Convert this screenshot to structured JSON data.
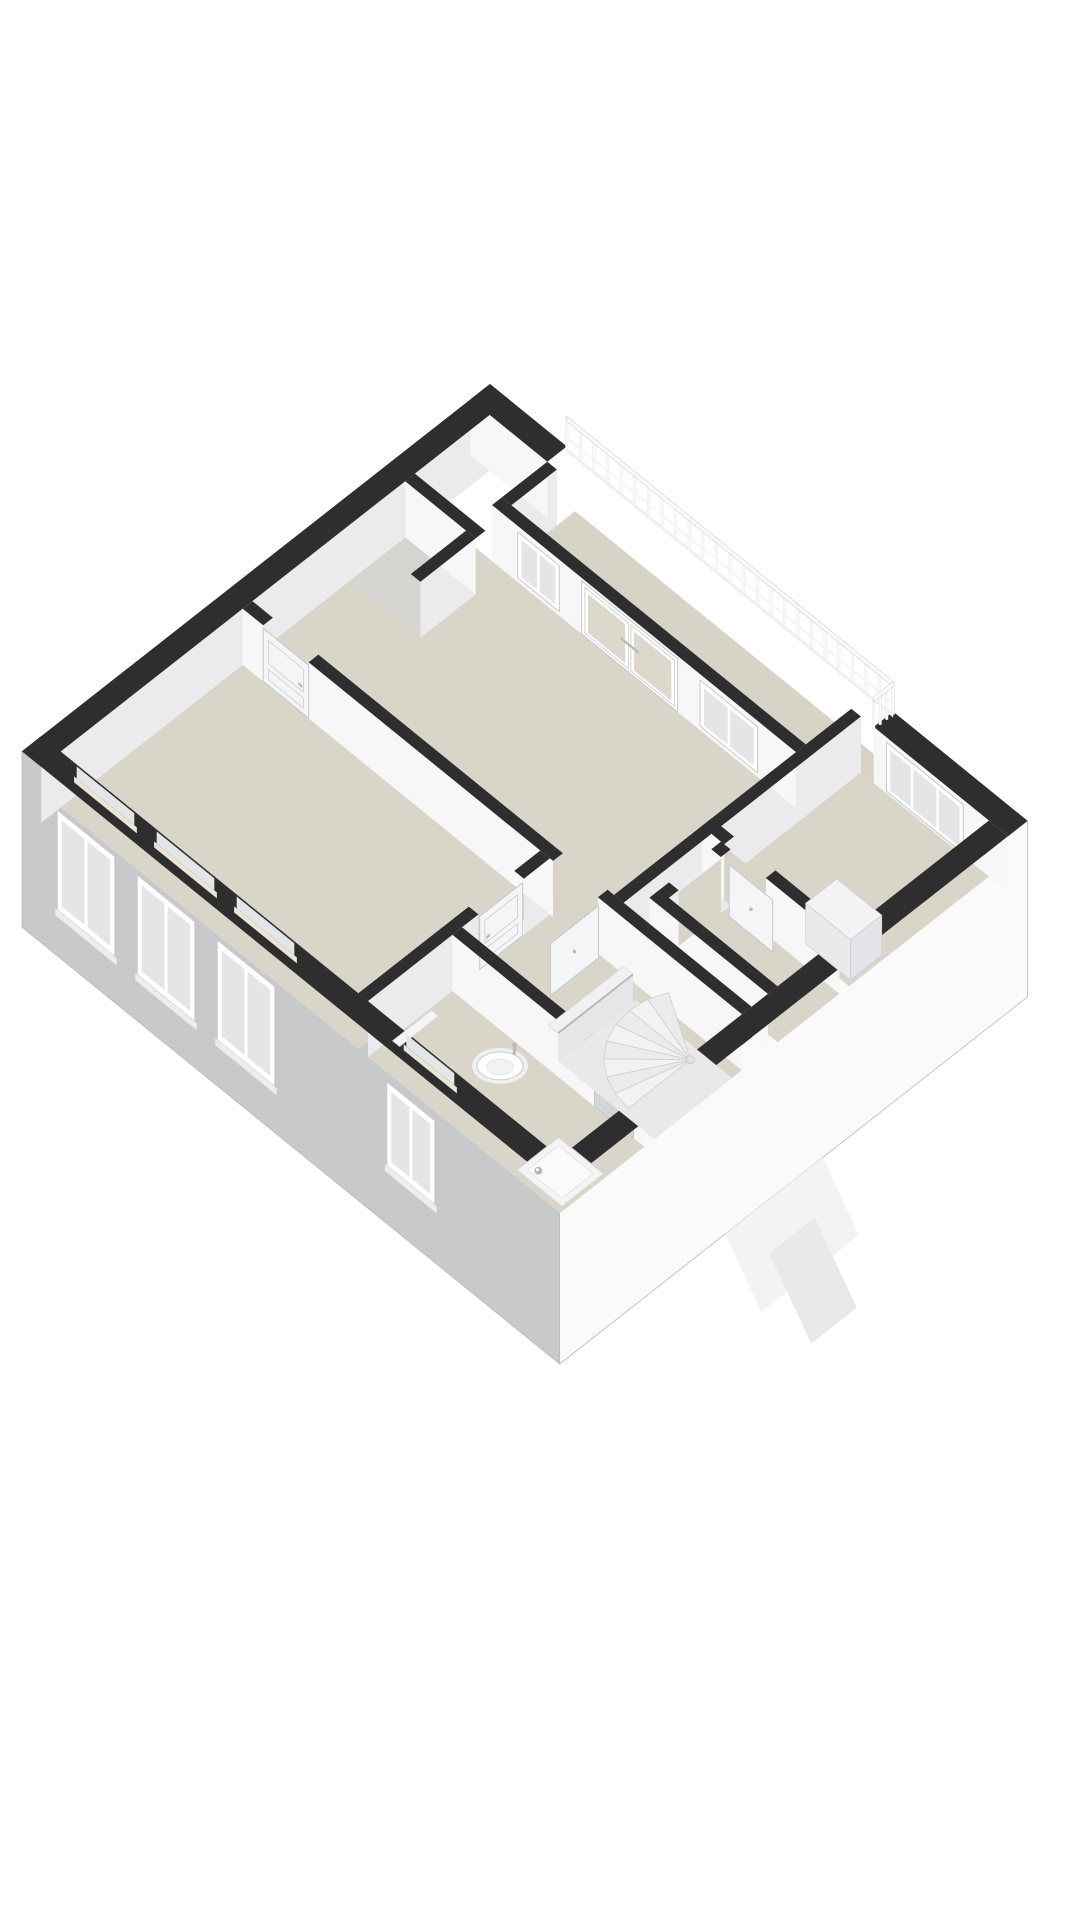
{
  "meta": {
    "kind": "3d-floorplan-render",
    "visible_text": ""
  },
  "scene": {
    "canvas": {
      "w": 1080,
      "h": 1920
    },
    "projection": {
      "origin": [
        490,
        384
      ],
      "ex": [
        64,
        52
      ],
      "ey": [
        -65,
        51
      ],
      "drop": 56,
      "facadeDrop": 176
    },
    "palette": {
      "bg": "#ffffff",
      "wallTop": "#2e2e2e",
      "floor": "#d9d5c9",
      "floorAlt": "#d4d4d0",
      "floorLoggia": "#d7d3c6",
      "faceLit": "#f7f7f8",
      "faceShade": "#ebebee",
      "opening": "#d8d4c8",
      "facadeSW": "#c8c9cb",
      "facadeSE": "#fafafb",
      "facadeEdge": "#b9babc",
      "glass": "#e3e5e7",
      "glassWarm": "#dcd8cc",
      "frame": "#ffffff",
      "frameEdge": "#c7c9cb",
      "sill": "#eae5d6",
      "tread": "#f2f2f3",
      "treadAlt": "#ebebed",
      "treadEdge": "#cfcfd2",
      "well": "#e9e9ea",
      "fixture": "#ffffff",
      "fixtureEdge": "#c9cbcd",
      "fixtureInner": "#f1f2f3",
      "chrome": "#b7babd",
      "leafGray": "#d4d6d9",
      "leafWhite": "#f4f5f6",
      "leafEdge": "#c5c7ca",
      "railPost": "#fbfbfc",
      "railPostShadow": "#e8e8ea",
      "railBar": "#fcfcfd",
      "railEdge": "#d5d5d8",
      "halfWallTop": "#f1f1f2",
      "halfWallFace": "#e6e6e9",
      "halfWallEdge": "#d9d9db",
      "cupboardTop": "#f3f3f4",
      "cupboardFace": "#e9eaec",
      "cupboardSide": "#e4e5e8",
      "cupboardEdge": "#cdcfd2",
      "dormer1": "#f3f3f5",
      "dormer2": "#e9e9ec"
    },
    "facades": {
      "sw": {
        "from": [
          0,
          7.2
        ],
        "to": [
          8.4,
          7.2
        ]
      },
      "se": {
        "from": [
          8.4,
          0
        ],
        "to": [
          8.4,
          7.2
        ]
      },
      "windows_sw": [
        {
          "name": "facade-window-1",
          "x": [
            0.55,
            1.45
          ],
          "d": [
            30,
            130
          ]
        },
        {
          "name": "facade-window-2",
          "x": [
            1.8,
            2.7
          ],
          "d": [
            30,
            130
          ]
        },
        {
          "name": "facade-window-3",
          "x": [
            3.05,
            3.95
          ],
          "d": [
            30,
            130
          ]
        },
        {
          "name": "facade-window-bathroom",
          "x": [
            5.7,
            6.45
          ],
          "d": [
            34,
            118
          ]
        }
      ],
      "dormers": [
        {
          "name": "lower-roof-dormer-a",
          "y": [
            3.15,
            4.65
          ],
          "off1": [
            0,
            0
          ],
          "off2": [
            36,
            78
          ],
          "fill": "dormer1"
        },
        {
          "name": "lower-roof-dormer-b",
          "y": [
            3.55,
            4.25
          ],
          "off1": [
            18,
            40
          ],
          "off2": [
            60,
            130
          ],
          "fill": "dormer2"
        }
      ]
    },
    "floors": [
      {
        "name": "floor-loggia",
        "rect": [
          1.35,
          0.02,
          6.3,
          1.0
        ],
        "fill": "floorLoggia"
      },
      {
        "name": "floor-top-bedroom",
        "rect": [
          0.3,
          1.15,
          5.95,
          3.95
        ],
        "fill": "floor"
      },
      {
        "name": "floor-closet-nook",
        "rect": [
          0.3,
          1.6,
          1.25,
          2.45
        ],
        "fill": "floorAlt"
      },
      {
        "name": "floor-right-bedroom",
        "rect": [
          6.1,
          0.3,
          8.1,
          2.45
        ],
        "fill": "floor"
      },
      {
        "name": "floor-small-room",
        "rect": [
          6.4,
          2.6,
          8.1,
          3.55
        ],
        "fill": "floor"
      },
      {
        "name": "floor-hall-landing",
        "rect": [
          5.1,
          4.1,
          8.1,
          5.45
        ],
        "fill": "floor"
      },
      {
        "name": "floor-left-room",
        "rect": [
          0.3,
          4.1,
          4.95,
          6.9
        ],
        "fill": "floor"
      },
      {
        "name": "floor-bathroom",
        "rect": [
          5.1,
          5.6,
          8.1,
          6.9
        ],
        "fill": "floor"
      }
    ],
    "walls": [
      {
        "name": "wall-envelope-nw",
        "rect": [
          0,
          0,
          0.3,
          7.2
        ],
        "face": "E"
      },
      {
        "name": "wall-envelope-ne-left",
        "rect": [
          0,
          0,
          1.2,
          0.3
        ],
        "face": "S"
      },
      {
        "name": "wall-envelope-ne-right",
        "rect": [
          6.3,
          0,
          8.4,
          0.3
        ],
        "face": "S"
      },
      {
        "name": "wall-envelope-se",
        "rect": [
          8.1,
          0.3,
          8.4,
          7.2
        ],
        "face": null
      },
      {
        "name": "wall-envelope-sw",
        "rect": [
          0,
          6.9,
          8.4,
          7.2
        ],
        "face": null
      },
      {
        "name": "wall-loggia-inset",
        "rect": [
          1.2,
          1.0,
          5.95,
          1.15
        ],
        "face": "S"
      },
      {
        "name": "wall-loggia-return",
        "rect": [
          1.2,
          0.3,
          1.35,
          1.0
        ],
        "face": "E"
      },
      {
        "name": "wall-partition-bedrooms",
        "rect": [
          5.95,
          0.3,
          6.1,
          3.95
        ],
        "face": "E"
      },
      {
        "name": "wall-a-1",
        "rect": [
          0.3,
          3.95,
          0.62,
          4.1
        ],
        "face": "S"
      },
      {
        "name": "wall-a-2",
        "rect": [
          1.33,
          3.95,
          5.15,
          4.1
        ],
        "face": "S"
      },
      {
        "name": "wall-a-3",
        "rect": [
          5.85,
          3.95,
          8.1,
          4.1
        ],
        "face": "S"
      },
      {
        "name": "wall-smallroom-n-1",
        "rect": [
          5.95,
          2.45,
          6.3,
          2.6
        ],
        "face": "S"
      },
      {
        "name": "wall-smallroom-n-2",
        "rect": [
          6.95,
          2.45,
          8.1,
          2.6
        ],
        "face": "S"
      },
      {
        "name": "wall-smallroom-w-1",
        "rect": [
          6.25,
          2.6,
          6.4,
          2.75
        ],
        "face": "E"
      },
      {
        "name": "wall-smallroom-w-2",
        "rect": [
          6.25,
          3.4,
          6.4,
          3.7
        ],
        "face": "E"
      },
      {
        "name": "wall-smallroom-s",
        "rect": [
          6.25,
          3.55,
          8.1,
          3.7
        ],
        "face": "S"
      },
      {
        "name": "wall-c-1",
        "rect": [
          4.95,
          4.1,
          5.1,
          4.5
        ],
        "face": "E"
      },
      {
        "name": "wall-c-2",
        "rect": [
          4.95,
          5.2,
          5.1,
          6.9
        ],
        "face": "E"
      },
      {
        "name": "wall-bathroom-n-1",
        "rect": [
          5.1,
          5.45,
          7.32,
          5.6
        ],
        "face": "S"
      },
      {
        "name": "wall-bathroom-n-2",
        "rect": [
          7.93,
          5.45,
          8.1,
          5.6
        ],
        "face": "S"
      },
      {
        "name": "wall-closet-n",
        "rect": [
          0.3,
          1.45,
          1.4,
          1.6
        ],
        "face": "S"
      },
      {
        "name": "wall-closet-e",
        "rect": [
          1.25,
          1.6,
          1.4,
          2.45
        ],
        "face": "E"
      }
    ],
    "faceItems": [
      {
        "name": "window-top-left",
        "type": "window",
        "edgeS": [
          1.6,
          1.15,
          2.25
        ],
        "d": [
          6,
          52
        ]
      },
      {
        "name": "french-doors-balcony",
        "type": "frenchdoor",
        "edgeS": [
          2.6,
          1.15,
          4.1
        ],
        "d": [
          3,
          56
        ]
      },
      {
        "name": "window-top-right",
        "type": "window",
        "edgeS": [
          4.45,
          1.15,
          5.35
        ],
        "d": [
          6,
          52
        ]
      },
      {
        "name": "window-right-bedroom",
        "type": "bigwindow",
        "edgeS": [
          6.5,
          0.3,
          7.7
        ],
        "d": [
          5,
          54
        ]
      },
      {
        "name": "door-left-room-closed",
        "type": "leafWhite",
        "edgeS": [
          0.62,
          4.1,
          1.33
        ],
        "d": [
          3,
          56
        ]
      },
      {
        "name": "doorway-top-bedroom",
        "type": "opening",
        "edgeS": [
          5.15,
          4.1,
          5.85
        ],
        "d": [
          2,
          56
        ]
      },
      {
        "name": "doorway-right-bedroom",
        "type": "opening",
        "edgeS": [
          6.3,
          2.6,
          6.95
        ],
        "d": [
          2,
          56
        ]
      },
      {
        "name": "doorway-small-room",
        "type": "opening",
        "edgeE": [
          6.4,
          2.75,
          3.4
        ],
        "d": [
          2,
          56
        ]
      },
      {
        "name": "door-bathroom-closed",
        "type": "leafGray",
        "edgeS": [
          7.32,
          5.6,
          7.93
        ],
        "d": [
          3,
          56
        ]
      },
      {
        "name": "door-hall-left-closed",
        "type": "leafWhite",
        "edgeE": [
          5.1,
          4.52,
          5.18
        ],
        "d": [
          3,
          56
        ]
      }
    ],
    "reveals_sw": [
      {
        "name": "window-reveal-1",
        "x": [
          0.55,
          1.45
        ]
      },
      {
        "name": "window-reveal-2",
        "x": [
          1.8,
          2.7
        ]
      },
      {
        "name": "window-reveal-3",
        "x": [
          3.05,
          3.95
        ]
      },
      {
        "name": "window-reveal-bathroom",
        "x": [
          5.7,
          6.45
        ]
      }
    ],
    "stair": {
      "name": "winder-staircase",
      "well": [
        6.6,
        4.25,
        8.1,
        5.45
      ],
      "center": [
        7.6,
        4.4
      ],
      "radius": 0.95,
      "a0": 90,
      "a1": 210,
      "steps": 8,
      "halfWall": {
        "rect": [
          6.45,
          4.3,
          6.6,
          5.45
        ],
        "h": 0.5
      }
    },
    "openLeaves": [
      {
        "name": "door-leaf-open-hall",
        "axis": "y",
        "at": 5.9,
        "from": 4.14,
        "to": 4.88
      },
      {
        "name": "door-leaf-open-small-room",
        "axis": "x",
        "at": 2.72,
        "from": 6.5,
        "to": 7.18
      }
    ],
    "fixtures": {
      "sink": {
        "name": "bathroom-sink",
        "c": [
          6.2,
          5.95
        ],
        "rx": 23,
        "ry": 14
      },
      "shower": {
        "name": "shower-tray",
        "rect": [
          7.35,
          6.18,
          8.05,
          6.82
        ],
        "drain": [
          7.52,
          6.66
        ]
      },
      "radiator": {
        "name": "bathroom-radiator",
        "rect": [
          5.13,
          5.95,
          5.24,
          6.55
        ]
      },
      "cupboard": {
        "name": "built-in-cupboard",
        "rect": [
          7.35,
          1.9,
          8.05,
          2.38
        ],
        "h": 0.72
      }
    },
    "railing": {
      "name": "balcony-railing",
      "from": [
        1.2,
        0
      ],
      "to": [
        6.3,
        0
      ],
      "posts": 24,
      "height": 30,
      "return": {
        "from": [
          6.3,
          0
        ],
        "to": [
          6.3,
          0.3
        ],
        "posts": 3
      }
    }
  }
}
